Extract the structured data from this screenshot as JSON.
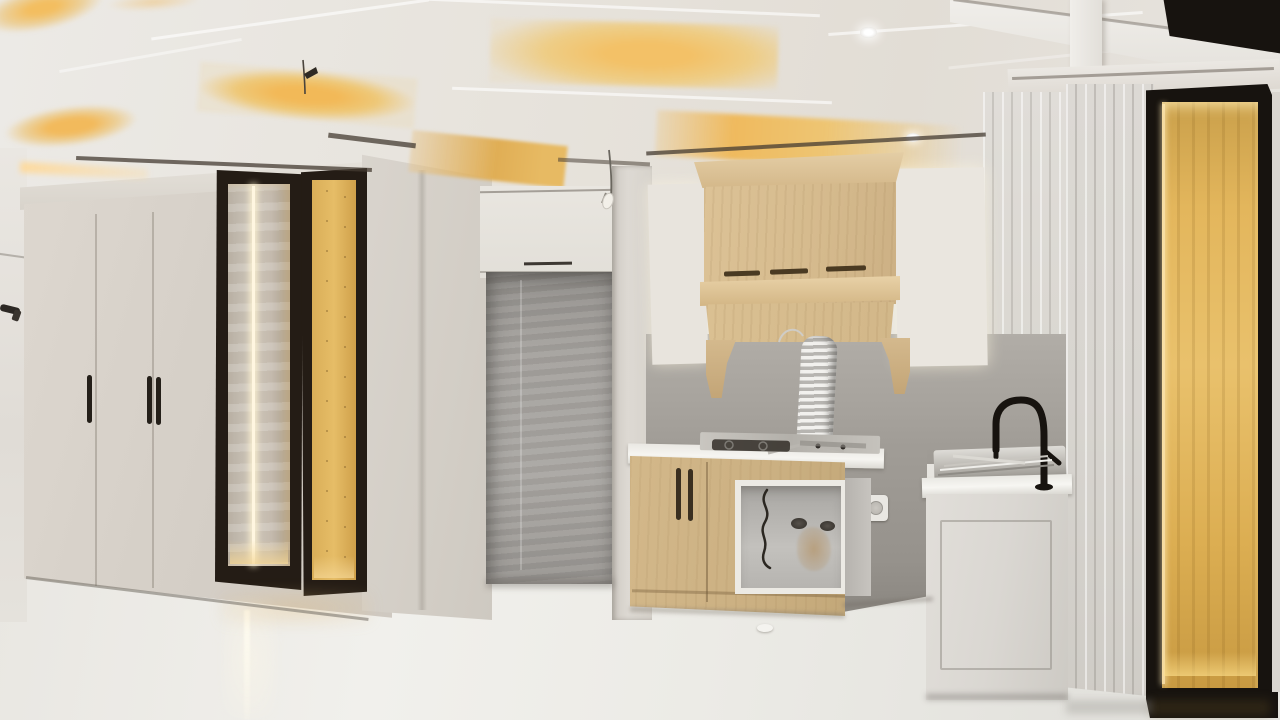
{
  "scene": {
    "title": "Newly built modern kitchen and living area with coffered LED ceiling, backlit display cabinets, wooden range hood and glossy tile floor",
    "type": "interior-photograph",
    "room": "kitchen / living area",
    "condition": "finishing stage: protective film on glass, exposed flex duct and wiring, uninstalled pendant wires"
  },
  "palette": {
    "ceiling": "#e6e2dc",
    "cove_glow": "#f2bd62",
    "cabinet_greige": "#d6d0c8",
    "hood_wood": "#d7bc90",
    "display_frame_black": "#1d1712",
    "display_amber": "#e0b257",
    "led_strip": "#fff6e0",
    "backsplash_gray": "#a8a49e",
    "niche_cement": "#a09d99",
    "counter_white": "#f3f2ee",
    "paneled_wall": "#d9d6d1",
    "sink_cabinet": "#dcdad5",
    "faucet_black": "#16130f",
    "floor": "#eceae5"
  },
  "glass_cabinets": {
    "rows": 4,
    "cols": 2
  },
  "objects": [
    "coffered ceiling with warm LED cove lighting",
    "recessed ceiling downlights",
    "greige wardrobe with vertical black pull handles",
    "pair of backlit display cabinets with black frames and LED strip",
    "unfinished cement fridge niche",
    "mullioned frosted-glass upper cabinets, backlit",
    "light-oak range hood mantel with corbels and vent slots",
    "flexible exhaust duct hanging unconnected",
    "stainless gas cooktop on white counter",
    "open base cabinet carcass with loose wiring",
    "wall power outlet",
    "stainless sink with drying rack and black gooseneck faucet",
    "white shaker sink base cabinet",
    "v-groove paneled tall cabinets",
    "tall backlit display niche with black frame (right)",
    "glossy porcelain floor with LED reflection streak",
    "bare pendant light wires"
  ]
}
